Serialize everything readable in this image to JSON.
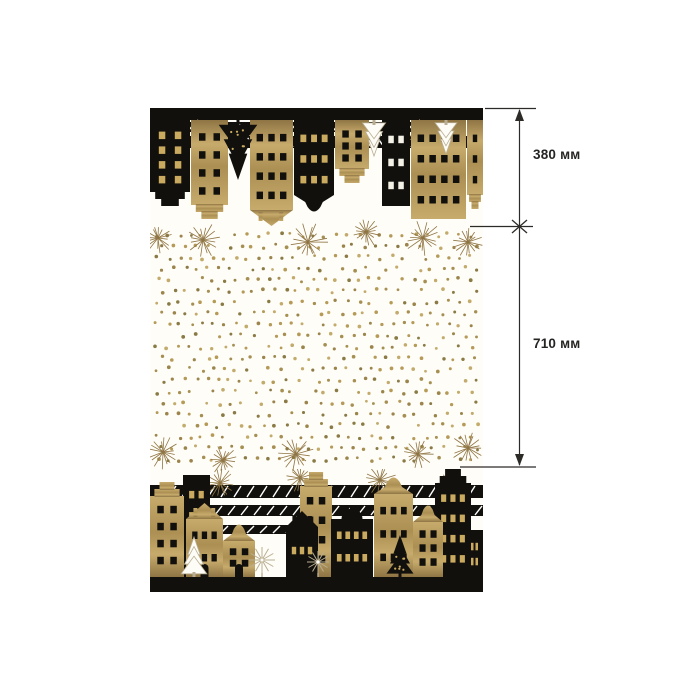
{
  "page": {
    "background_color": "#ffffff"
  },
  "annotations": {
    "line_color": "#2d2b28",
    "label_color": "#262523",
    "segments": [
      {
        "label": "380 мм"
      },
      {
        "label": "710 мм"
      }
    ]
  },
  "fabric": {
    "description": "black-and-gold scandinavian houses christmas fabric panel",
    "colors": {
      "black": "#12100c",
      "gold_1": "#c7ab6c",
      "gold_2": "#ab8f53",
      "gold_3": "#8f7544",
      "gold_window": "#c9aa5f",
      "white_window": "#f4f1e7",
      "cream": "#fffdf7",
      "tree_white": "#fdfcf6",
      "tree_white_stroke": "#b9ae93"
    },
    "top_band": {
      "bar_height": 12,
      "stripes": {
        "x": 0,
        "y": 56,
        "w": 40,
        "count": 5,
        "h": 6,
        "gap": 5
      },
      "slats": [
        {
          "x": 0,
          "y": 80,
          "w": 333,
          "h": 12
        },
        {
          "x": 30,
          "y": 96,
          "w": 280,
          "h": 10
        }
      ],
      "bursts": [
        {
          "x": 55,
          "y": 96,
          "r": 16
        },
        {
          "x": 160,
          "y": 92,
          "r": 18
        },
        {
          "x": 272,
          "y": 94,
          "r": 16
        }
      ],
      "houses": [
        {
          "x": 0,
          "w": 40,
          "h": 86,
          "color": "black",
          "roof": "step",
          "win": "gold",
          "cols": 2,
          "rows": 4
        },
        {
          "x": 41,
          "w": 37,
          "h": 99,
          "color": "gold",
          "roof": "step",
          "win": "black",
          "cols": 2,
          "rows": 4
        },
        {
          "x": 100,
          "w": 43,
          "h": 106,
          "color": "gold",
          "roof": "point",
          "win": "black",
          "cols": 3,
          "rows": 4
        },
        {
          "x": 144,
          "w": 40,
          "h": 93,
          "color": "black",
          "roof": "bell",
          "win": "gold",
          "cols": 3,
          "rows": 3
        },
        {
          "x": 185,
          "w": 34,
          "h": 63,
          "color": "gold",
          "roof": "step",
          "win": "black",
          "cols": 2,
          "rows": 3
        },
        {
          "x": 232,
          "w": 28,
          "h": 86,
          "color": "black",
          "roof": "flat",
          "win": "white",
          "cols": 2,
          "rows": 3
        },
        {
          "x": 261,
          "w": 55,
          "h": 99,
          "color": "gold",
          "roof": "flat",
          "win": "black",
          "cols": 4,
          "rows": 4
        },
        {
          "x": 317,
          "w": 16,
          "h": 89,
          "color": "gold",
          "roof": "step",
          "win": "black",
          "cols": 1,
          "rows": 3
        }
      ],
      "trees": [
        {
          "type": "fir",
          "color": "black",
          "x": 88,
          "h": 60
        },
        {
          "type": "fir",
          "color": "white",
          "x": 224,
          "h": 36
        },
        {
          "type": "fir",
          "color": "white",
          "x": 296,
          "h": 34
        }
      ]
    },
    "bottom_band": {
      "bar_height": 15,
      "stripes": {
        "x": 0,
        "y": 60,
        "w": 0,
        "count": 0,
        "h": 0,
        "gap": 0
      },
      "slats": [
        {
          "x": 0,
          "y": 16,
          "w": 333,
          "h": 13
        },
        {
          "x": 20,
          "y": 36,
          "w": 313,
          "h": 11
        },
        {
          "x": 0,
          "y": 56,
          "w": 150,
          "h": 9
        }
      ],
      "bursts": [
        {
          "x": 70,
          "y": 14,
          "r": 17
        },
        {
          "x": 150,
          "y": 9,
          "r": 15
        },
        {
          "x": 230,
          "y": 11,
          "r": 17
        },
        {
          "x": 302,
          "y": 16,
          "r": 15
        }
      ],
      "houses": [
        {
          "x": 33,
          "w": 27,
          "h": 102,
          "color": "black",
          "roof": "flat",
          "win": "gold",
          "cols": 2,
          "rows": 4
        },
        {
          "x": 0,
          "w": 34,
          "h": 95,
          "color": "gold",
          "roof": "step",
          "win": "black",
          "cols": 2,
          "rows": 4
        },
        {
          "x": 36,
          "w": 37,
          "h": 74,
          "color": "gold",
          "roof": "point",
          "win": "black",
          "cols": 3,
          "rows": 2,
          "door": true
        },
        {
          "x": 73,
          "w": 32,
          "h": 54,
          "color": "gold",
          "roof": "bell",
          "win": "black",
          "cols": 2,
          "rows": 2,
          "door": true
        },
        {
          "x": 150,
          "w": 32,
          "h": 105,
          "color": "gold",
          "roof": "step",
          "win": "black",
          "cols": 2,
          "rows": 4
        },
        {
          "x": 136,
          "w": 32,
          "h": 66,
          "color": "black",
          "roof": "point",
          "win": "gold",
          "cols": 3,
          "rows": 1,
          "door": true
        },
        {
          "x": 181,
          "w": 42,
          "h": 70,
          "color": "black",
          "roof": "dome",
          "win": "gold",
          "cols": 4,
          "rows": 2
        },
        {
          "x": 224,
          "w": 39,
          "h": 101,
          "color": "gold",
          "roof": "bell",
          "win": "black",
          "cols": 3,
          "rows": 3
        },
        {
          "x": 285,
          "w": 36,
          "h": 108,
          "color": "black",
          "roof": "step",
          "win": "gold",
          "cols": 3,
          "rows": 4
        },
        {
          "x": 263,
          "w": 30,
          "h": 73,
          "color": "gold",
          "roof": "bell",
          "win": "black",
          "cols": 2,
          "rows": 3
        },
        {
          "x": 316,
          "w": 17,
          "h": 47,
          "color": "black",
          "roof": "flat",
          "win": "gold",
          "cols": 2,
          "rows": 2
        }
      ],
      "trees": [
        {
          "type": "fir",
          "color": "white",
          "x": 44,
          "h": 40
        },
        {
          "type": "round",
          "color": "white",
          "x": 112,
          "h": 26
        },
        {
          "type": "round",
          "color": "white",
          "x": 168,
          "h": 22
        },
        {
          "type": "fir",
          "color": "black",
          "x": 250,
          "h": 42
        }
      ]
    },
    "dots": {
      "x0": 7,
      "x1": 327,
      "y0": 127,
      "y1": 358,
      "col_gap": 11.2,
      "row_gap": 11.2,
      "jitter": 2.2,
      "r_min": 1.35,
      "r_max": 1.9,
      "skip": 0.12,
      "colors": [
        "#9b854c",
        "#b59a58",
        "#8a7a45",
        "#c2ab6c",
        "#a68f52"
      ],
      "bursts": [
        {
          "x": 8,
          "y": 130,
          "r": 17
        },
        {
          "x": 53,
          "y": 132,
          "r": 18
        },
        {
          "x": 158,
          "y": 134,
          "r": 20
        },
        {
          "x": 216,
          "y": 124,
          "r": 16
        },
        {
          "x": 273,
          "y": 130,
          "r": 19
        },
        {
          "x": 318,
          "y": 134,
          "r": 16
        },
        {
          "x": 13,
          "y": 344,
          "r": 18
        },
        {
          "x": 73,
          "y": 352,
          "r": 15
        },
        {
          "x": 146,
          "y": 346,
          "r": 19
        },
        {
          "x": 268,
          "y": 346,
          "r": 16
        },
        {
          "x": 318,
          "y": 340,
          "r": 18
        }
      ]
    }
  }
}
